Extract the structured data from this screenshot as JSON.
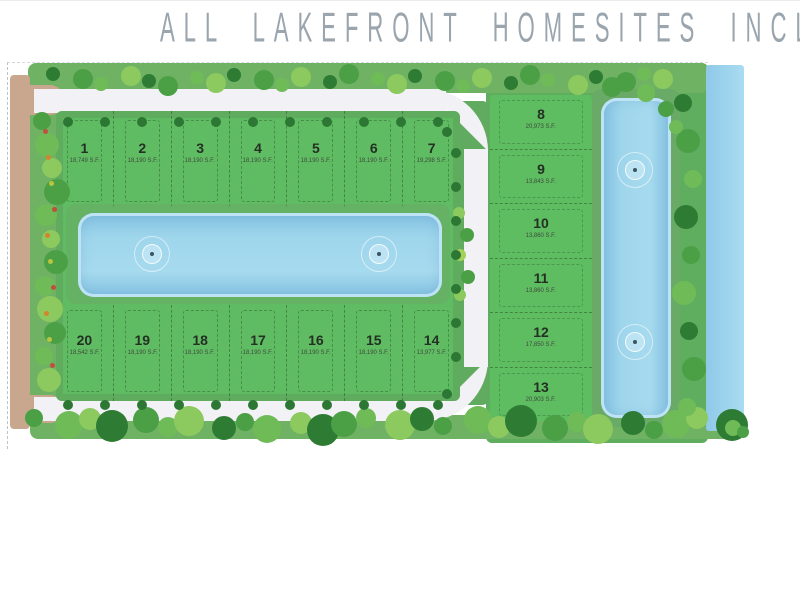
{
  "title": "ALL LAKEFRONT HOMESITES INCLUDED",
  "site_plan": {
    "lots_top": [
      {
        "number": "1",
        "size": "18,749 S.F."
      },
      {
        "number": "2",
        "size": "18,190 S.F."
      },
      {
        "number": "3",
        "size": "18,190 S.F."
      },
      {
        "number": "4",
        "size": "18,190 S.F."
      },
      {
        "number": "5",
        "size": "18,190 S.F."
      },
      {
        "number": "6",
        "size": "18,190 S.F."
      },
      {
        "number": "7",
        "size": "19,298 S.F."
      }
    ],
    "lots_bottom": [
      {
        "number": "20",
        "size": "18,542 S.F."
      },
      {
        "number": "19",
        "size": "18,190 S.F."
      },
      {
        "number": "18",
        "size": "18,190 S.F."
      },
      {
        "number": "17",
        "size": "18,190 S.F."
      },
      {
        "number": "16",
        "size": "18,190 S.F."
      },
      {
        "number": "15",
        "size": "18,190 S.F."
      },
      {
        "number": "14",
        "size": "13,977 S.F."
      }
    ],
    "lots_right": [
      {
        "number": "8",
        "size": "20,973 S.F."
      },
      {
        "number": "9",
        "size": "13,843 S.F."
      },
      {
        "number": "10",
        "size": "13,860 S.F."
      },
      {
        "number": "11",
        "size": "13,860 S.F."
      },
      {
        "number": "12",
        "size": "17,850 S.F."
      },
      {
        "number": "13",
        "size": "20,903 S.F."
      }
    ],
    "features": {
      "central_lake_fountains": 2,
      "east_lake_fountains": 2,
      "lakes": 3
    },
    "colors": {
      "lot_green": "#5ebc61",
      "buffer_green": "#6fb263",
      "lake_blue": "#9fd6ec",
      "lake_rim": "#bde3f4",
      "road": "#f2f1f5",
      "path_tan": "#c9a78f",
      "tree_dark": "#2e7c34",
      "tree_mid": "#4ba046",
      "tree_light": "#8cc95e",
      "accent_red": "#c0503c",
      "accent_orange": "#d3842f",
      "title_gray": "#9aa5ae"
    }
  }
}
